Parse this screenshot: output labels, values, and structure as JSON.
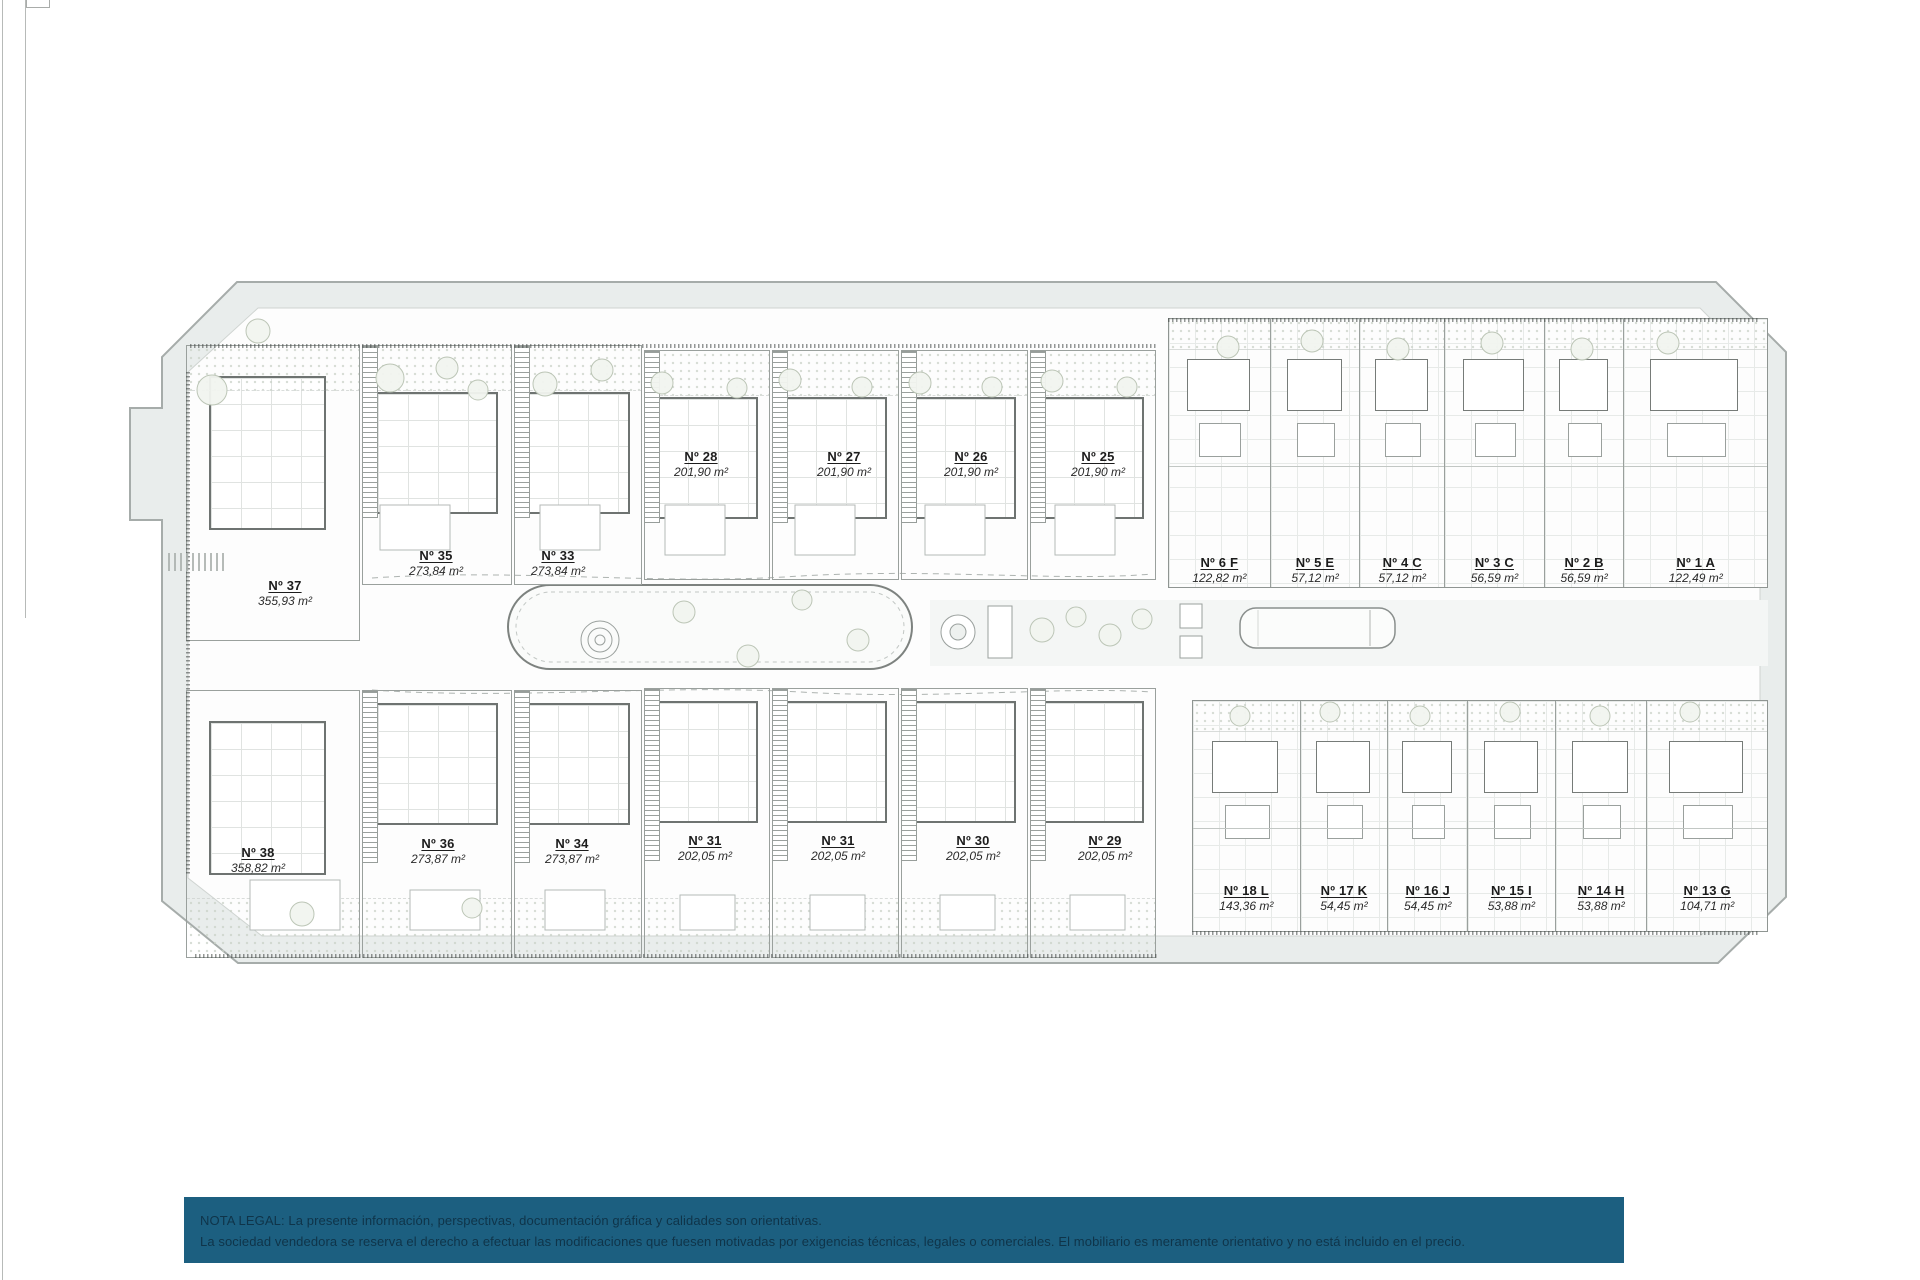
{
  "units": {
    "top_left_villas": [
      {
        "number": "Nº 37",
        "area": "355,93 m²"
      },
      {
        "number": "Nº 35",
        "area": "273,84 m²"
      },
      {
        "number": "Nº 33",
        "area": "273,84 m²"
      }
    ],
    "top_middle_villas": [
      {
        "number": "Nº 28",
        "area": "201,90 m²"
      },
      {
        "number": "Nº 27",
        "area": "201,90 m²"
      },
      {
        "number": "Nº 26",
        "area": "201,90 m²"
      },
      {
        "number": "Nº 25",
        "area": "201,90 m²"
      }
    ],
    "top_right_apartments": [
      {
        "number": "Nº 6 F",
        "area": "122,82 m²"
      },
      {
        "number": "Nº 5 E",
        "area": "57,12 m²"
      },
      {
        "number": "Nº 4 C",
        "area": "57,12 m²"
      },
      {
        "number": "Nº 3 C",
        "area": "56,59 m²"
      },
      {
        "number": "Nº 2 B",
        "area": "56,59 m²"
      },
      {
        "number": "Nº 1 A",
        "area": "122,49 m²"
      }
    ],
    "bottom_left_villas": [
      {
        "number": "Nº 38",
        "area": "358,82 m²"
      },
      {
        "number": "Nº 36",
        "area": "273,87 m²"
      },
      {
        "number": "Nº 34",
        "area": "273,87 m²"
      }
    ],
    "bottom_middle_villas": [
      {
        "number": "Nº 31",
        "area": "202,05 m²"
      },
      {
        "number": "Nº 31",
        "area": "202,05 m²"
      },
      {
        "number": "Nº 30",
        "area": "202,05 m²"
      },
      {
        "number": "Nº 29",
        "area": "202,05 m²"
      }
    ],
    "bottom_right_apartments": [
      {
        "number": "Nº 18 L",
        "area": "143,36 m²"
      },
      {
        "number": "Nº 17 K",
        "area": "54,45 m²"
      },
      {
        "number": "Nº 16 J",
        "area": "54,45 m²"
      },
      {
        "number": "Nº 15 I",
        "area": "53,88 m²"
      },
      {
        "number": "Nº 14 H",
        "area": "53,88 m²"
      },
      {
        "number": "Nº 13 G",
        "area": "104,71 m²"
      }
    ]
  },
  "legal_note": {
    "line1": "NOTA LEGAL: La presente información, perspectivas, documentación gráfica y calidades son orientativas.",
    "line2": "La sociedad vendedora se reserva el derecho a efectuar las modificaciones que fuesen motivadas por exigencias técnicas, legales o comerciales. El mobiliario es meramente orientativo y no está incluido en el precio."
  },
  "colors": {
    "legal_banner_background": "#1c5f80",
    "legal_banner_text": "#0f3449",
    "parcel_fill": "#e9edec",
    "drawing_line": "#8f9592"
  }
}
